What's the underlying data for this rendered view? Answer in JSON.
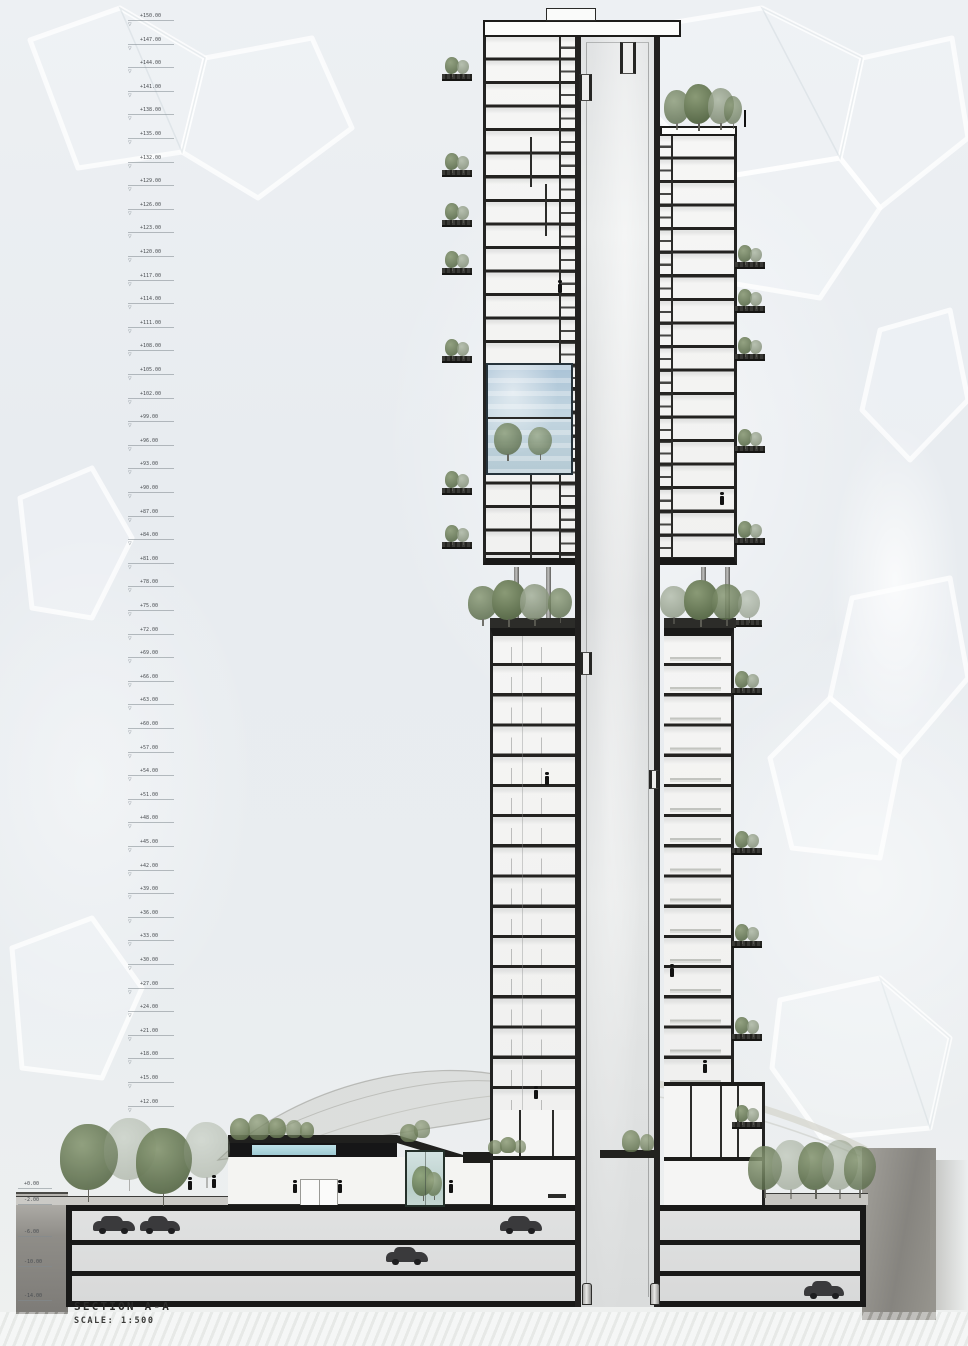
{
  "drawing": {
    "title": "SECTION A-A",
    "scale_label": "SCALE: 1:500"
  },
  "elevation_markers": {
    "values": [
      "+150.00",
      "+147.00",
      "+144.00",
      "+141.00",
      "+138.00",
      "+135.00",
      "+132.00",
      "+129.00",
      "+126.00",
      "+123.00",
      "+120.00",
      "+117.00",
      "+114.00",
      "+111.00",
      "+108.00",
      "+105.00",
      "+102.00",
      "+99.00",
      "+96.00",
      "+93.00",
      "+90.00",
      "+87.00",
      "+84.00",
      "+81.00",
      "+78.00",
      "+75.00",
      "+72.00",
      "+69.00",
      "+66.00",
      "+63.00",
      "+60.00",
      "+57.00",
      "+54.00",
      "+51.00",
      "+48.00",
      "+45.00",
      "+42.00",
      "+39.00",
      "+36.00",
      "+33.00",
      "+30.00",
      "+27.00",
      "+24.00",
      "+21.00",
      "+18.00",
      "+15.00",
      "+12.00"
    ]
  },
  "datum_markers": {
    "values": [
      "+0.00",
      "-2.00",
      "-6.00",
      "-10.00",
      "-14.00"
    ]
  },
  "colors": {
    "background": "#e9edf0",
    "ink": "#1f1f1e",
    "core_fill": "#dcdedf",
    "glass_blue": "#b7cddc",
    "pool_blue": "#aad6de",
    "tree_green_dark": "#6e7c5c",
    "tree_green_light": "#9aa687",
    "soil_gray": "#8f8d88",
    "car_dark": "#3a3a3c",
    "paper_white": "#f2f3f2"
  },
  "icons": {
    "elevation_marker": "triangle-down-icon",
    "vegetation": "tree-icon",
    "vehicle": "car-icon",
    "figure": "person-icon",
    "lift": "elevator-icon"
  }
}
